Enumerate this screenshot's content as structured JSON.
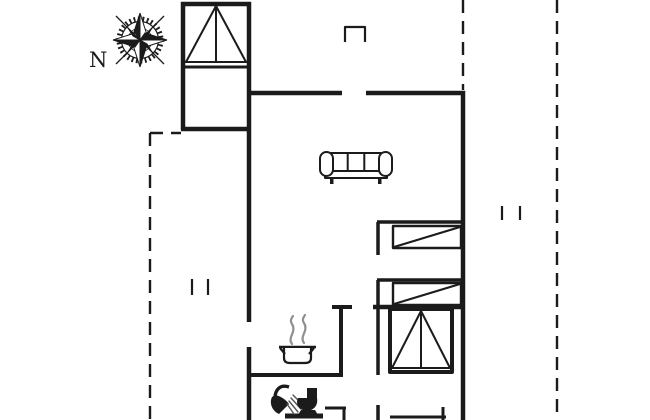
{
  "compass": {
    "label": "N"
  },
  "colors": {
    "line": "#1b1b1b",
    "steam": "#8f8f8f",
    "spray": "#565656",
    "background": "#ffffff"
  },
  "icons": {
    "compass_rose": "compass-rose-icon",
    "sofa": "sofa-icon",
    "cooking_pot": "cooking-pot-with-steam-icon",
    "shower": "shower-head-icon",
    "toilet": "toilet-icon",
    "bunk_bed_top_room": "bunk-bed-symbol",
    "bunk_bed_bottom_room": "bunk-bed-symbol",
    "single_bed_upper": "single-bed-symbol",
    "single_bed_lower": "single-bed-symbol"
  }
}
